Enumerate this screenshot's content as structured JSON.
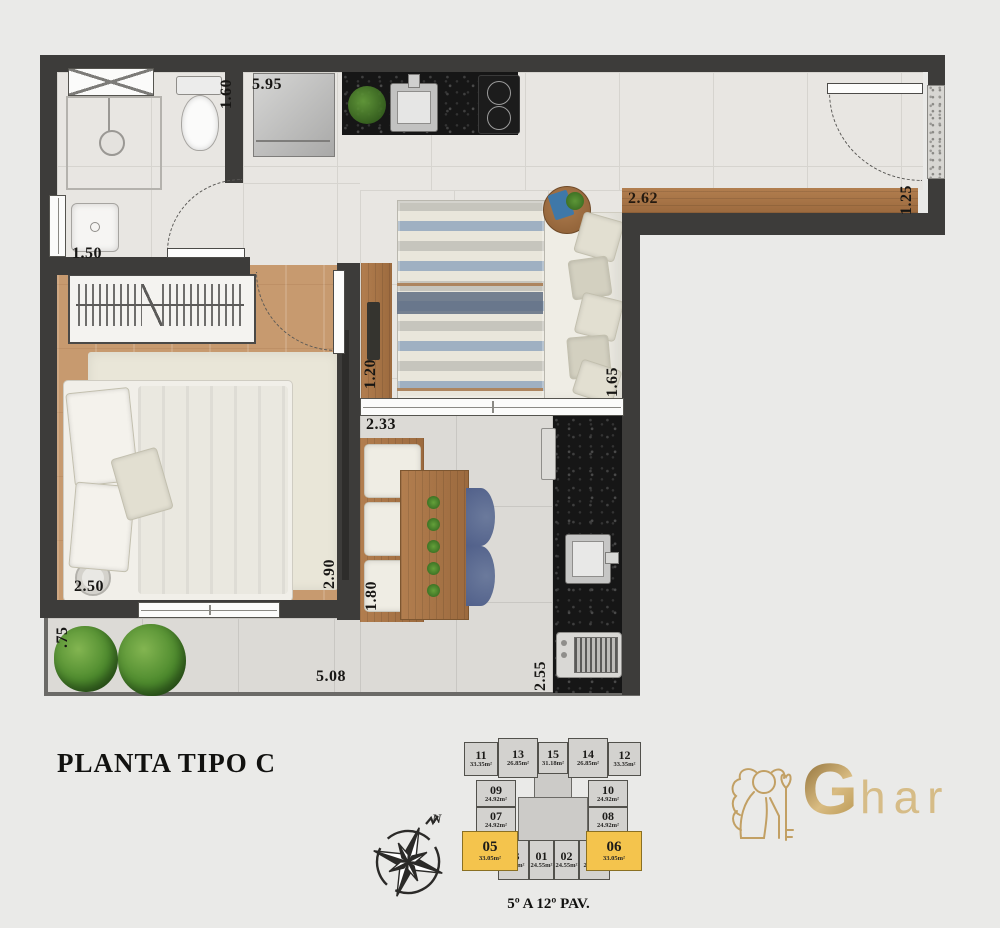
{
  "title": "PLANTA TIPO C",
  "caption": "5º A 12º PAV.",
  "compass": {
    "north_label": "N"
  },
  "logo": {
    "g_letter": "G",
    "rest": "har",
    "gold_color": "#c5a05e"
  },
  "colors": {
    "wall": "#3d3c3a",
    "highlight_yellow": "#f4c44d",
    "wood": "#ab7447",
    "granite": "#161616"
  },
  "dimensions": {
    "kitchen_top": "5.95",
    "bath_right": "1.60",
    "bath_sink": "1.50",
    "hall_bench": "2.62",
    "entry_door": "1.25",
    "tv_console": "1.20",
    "living_window": "2.33",
    "sofa_depth": "1.65",
    "bed_width": "2.50",
    "bedroom_wall": "2.90",
    "dining_bench": "1.80",
    "terrace_width": "5.08",
    "grill_counter": "2.55",
    "garden_depth": ".75"
  },
  "keyplan": {
    "units": [
      {
        "id": "11",
        "area": "33.35m²",
        "highlight": false
      },
      {
        "id": "13",
        "area": "26.85m²",
        "highlight": false
      },
      {
        "id": "15",
        "area": "31.18m²",
        "highlight": false
      },
      {
        "id": "14",
        "area": "26.85m²",
        "highlight": false
      },
      {
        "id": "12",
        "area": "33.35m²",
        "highlight": false
      },
      {
        "id": "09",
        "area": "24.92m²",
        "highlight": false
      },
      {
        "id": "10",
        "area": "24.92m²",
        "highlight": false
      },
      {
        "id": "07",
        "area": "24.92m²",
        "highlight": false
      },
      {
        "id": "08",
        "area": "24.92m²",
        "highlight": false
      },
      {
        "id": "05",
        "area": "33.05m²",
        "highlight": true
      },
      {
        "id": "03",
        "area": "23.65m²",
        "highlight": false
      },
      {
        "id": "01",
        "area": "24.55m²",
        "highlight": false
      },
      {
        "id": "02",
        "area": "24.55m²",
        "highlight": false
      },
      {
        "id": "04",
        "area": "23.65m²",
        "highlight": false
      },
      {
        "id": "06",
        "area": "33.05m²",
        "highlight": true
      }
    ]
  }
}
